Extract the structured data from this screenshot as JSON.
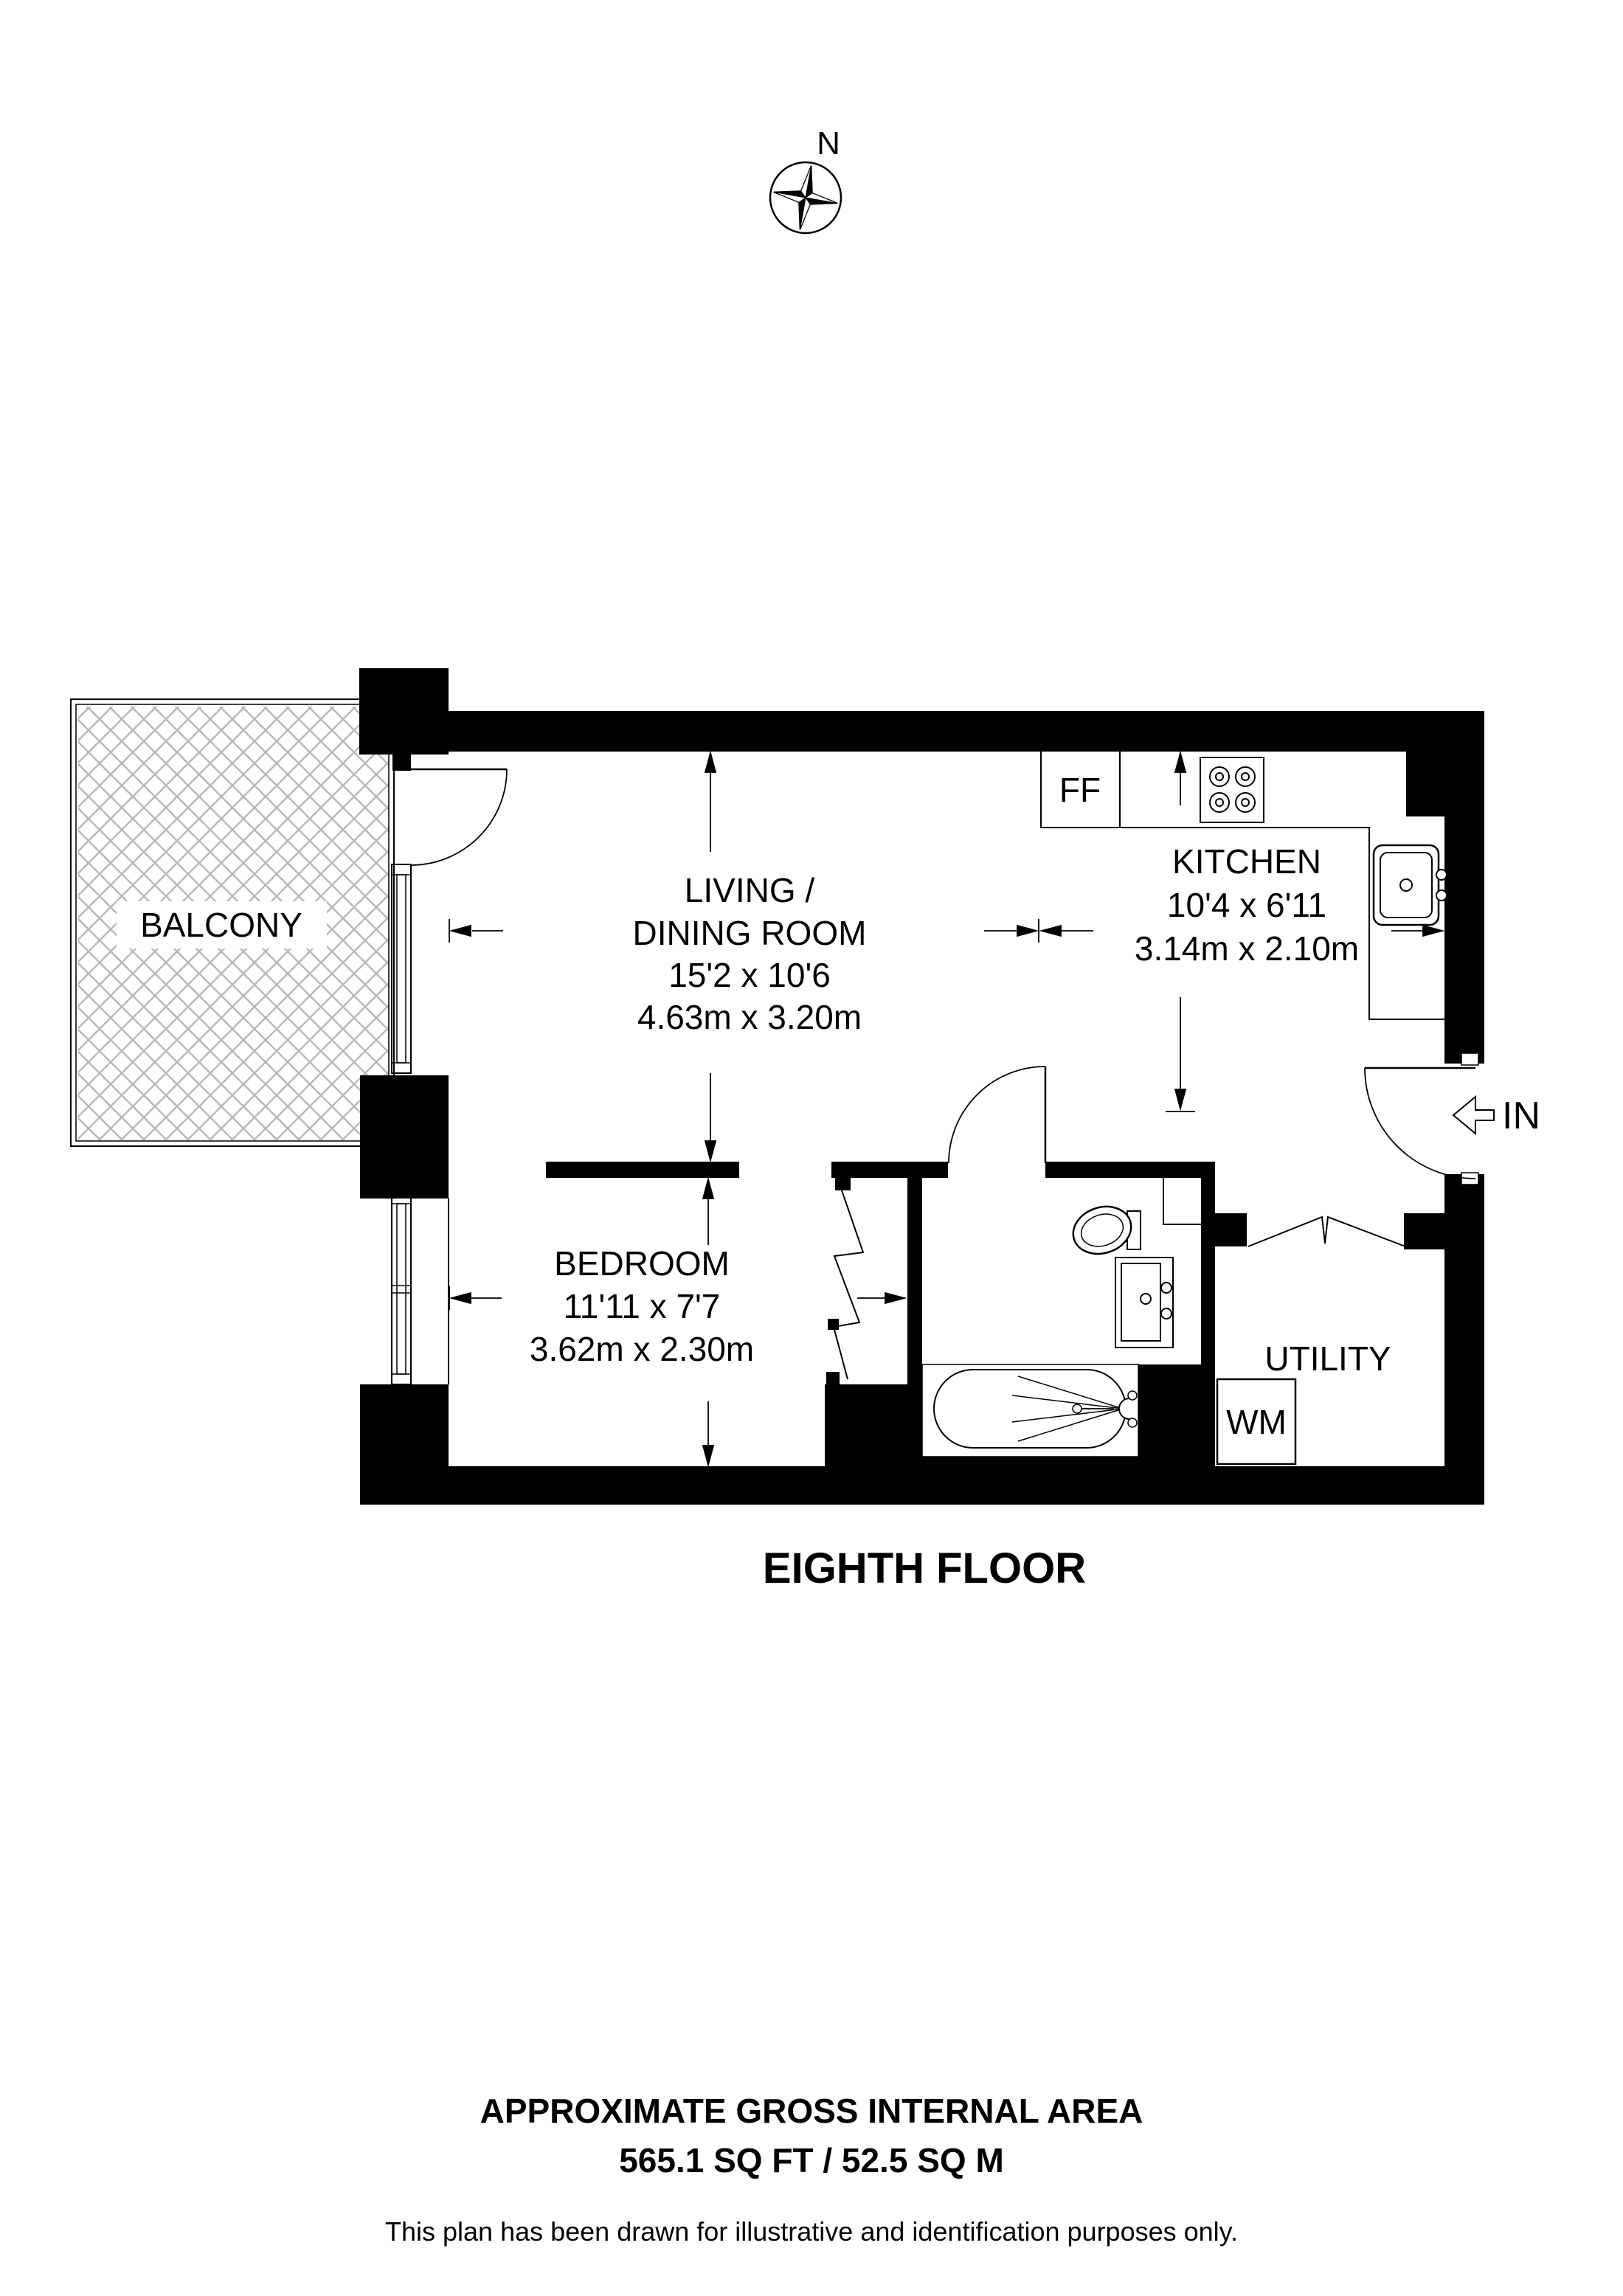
{
  "compass": {
    "north_label": "N"
  },
  "rooms": {
    "balcony": {
      "name": "BALCONY"
    },
    "living": {
      "line1": "LIVING /",
      "line2": "DINING ROOM",
      "imperial": "15'2 x 10'6",
      "metric": "4.63m x 3.20m"
    },
    "kitchen": {
      "name": "KITCHEN",
      "imperial": "10'4 x 6'11",
      "metric": "3.14m x 2.10m"
    },
    "bedroom": {
      "name": "BEDROOM",
      "imperial": "11'11 x 7'7",
      "metric": "3.62m x 2.30m"
    },
    "utility": {
      "name": "UTILITY"
    }
  },
  "fixtures": {
    "fridge_freezer": "FF",
    "washing_machine": "WM"
  },
  "entrance": {
    "label": "IN"
  },
  "floor": {
    "title": "EIGHTH FLOOR"
  },
  "footer": {
    "area_heading": "APPROXIMATE GROSS INTERNAL AREA",
    "area_value": "565.1 SQ FT / 52.5 SQ M",
    "disclaimer": "This plan has been drawn for illustrative and identification purposes only."
  },
  "colors": {
    "wall": "#000000",
    "hatch": "#b9b9b9",
    "background": "#ffffff"
  }
}
